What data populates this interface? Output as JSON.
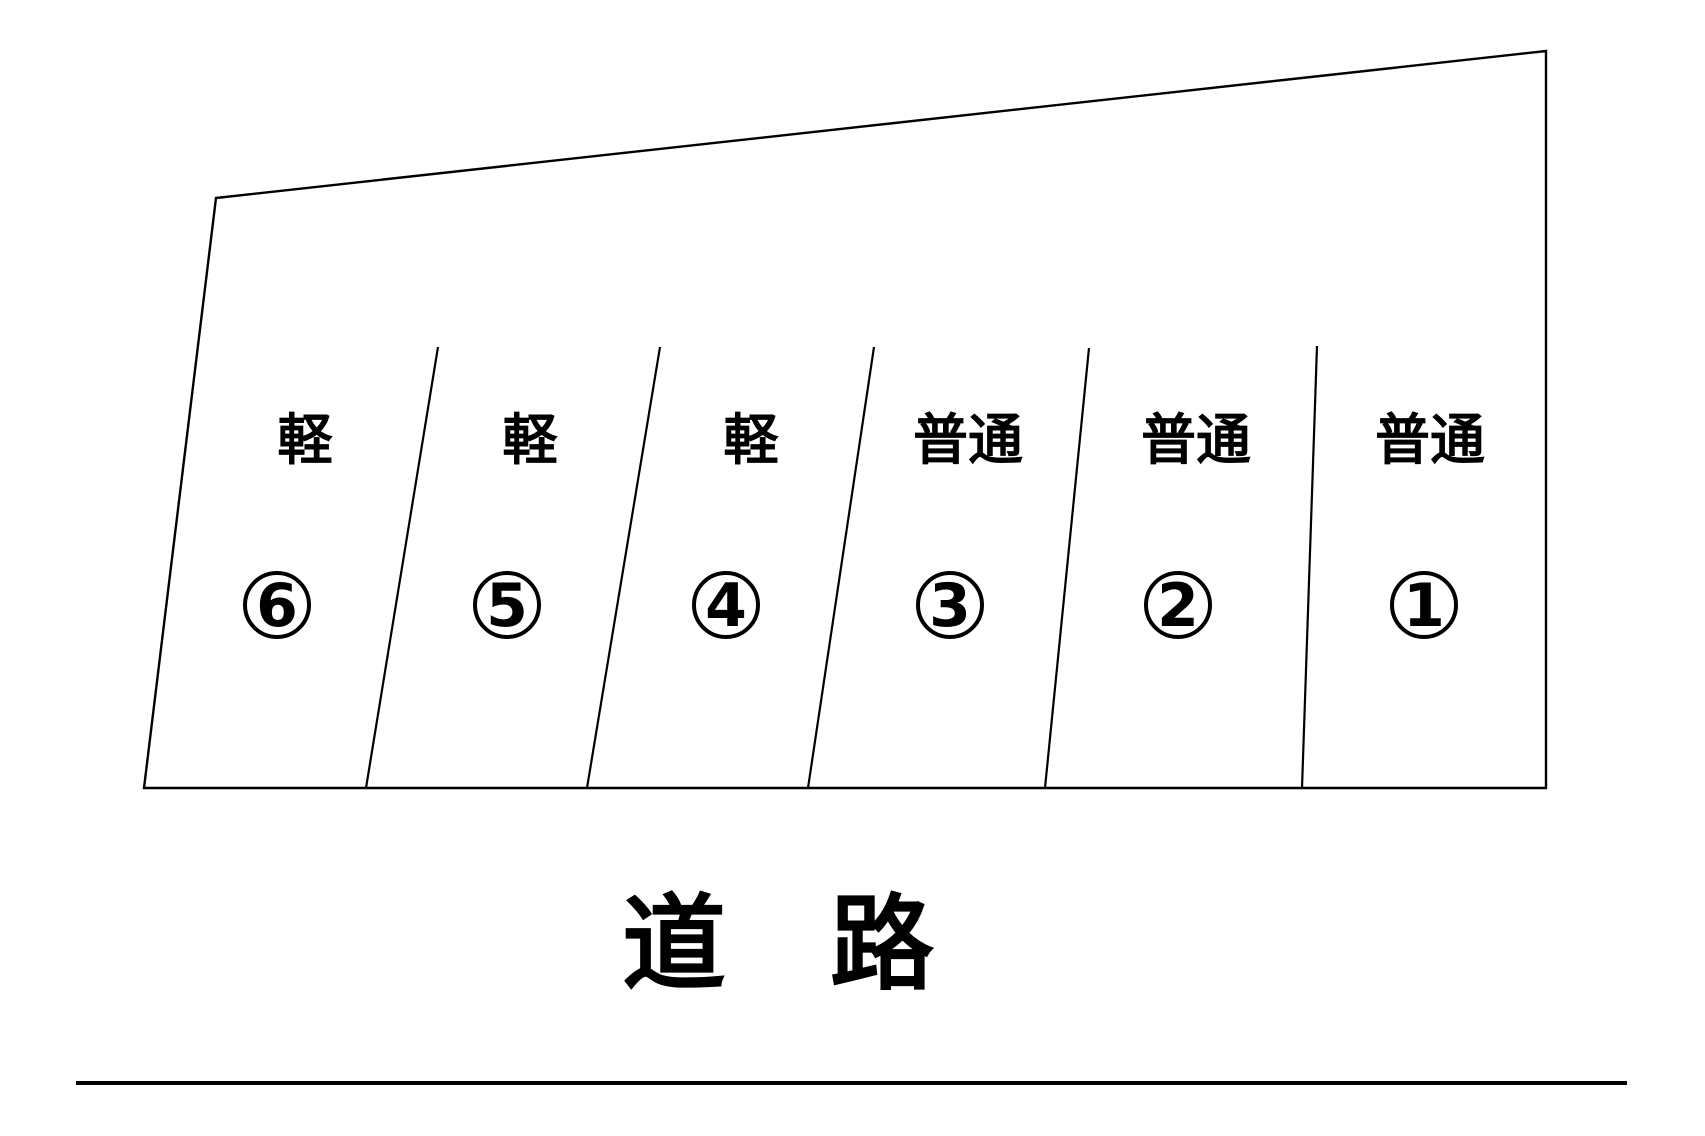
{
  "lot": {
    "spaces": [
      {
        "number": "1",
        "type": "普通"
      },
      {
        "number": "2",
        "type": "普通"
      },
      {
        "number": "3",
        "type": "普通"
      },
      {
        "number": "4",
        "type": "軽"
      },
      {
        "number": "5",
        "type": "軽"
      },
      {
        "number": "6",
        "type": "軽"
      }
    ]
  },
  "road": {
    "label": "道　路"
  },
  "colors": {
    "line": "#000000",
    "background": "#ffffff"
  }
}
